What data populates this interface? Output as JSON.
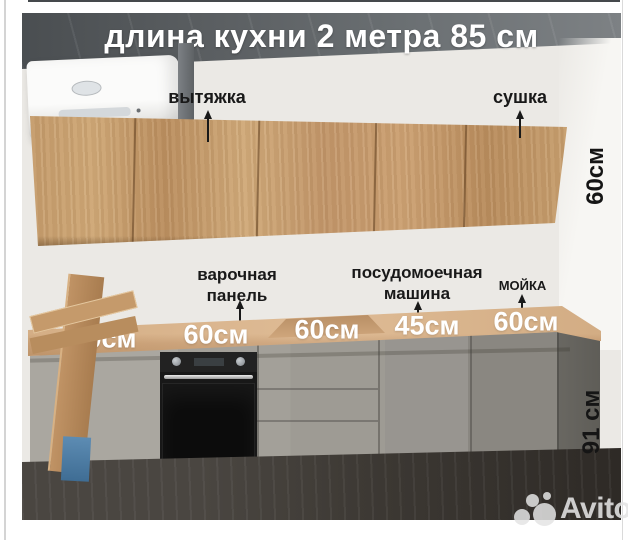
{
  "page": {
    "title": "длина кухни 2 метра 85 см",
    "watermark_text": "Avito"
  },
  "labels": {
    "hood": "вытяжка",
    "dryer": "сушка",
    "hob_line1": "варочная",
    "hob_line2": "панель",
    "dishwasher_line1": "посудомоечная",
    "dishwasher_line2": "машина",
    "sink": "МОЙКА",
    "upper_cabinet_height": "60см",
    "base_cabinet_height": "91 см"
  },
  "counter_widths": [
    "60см",
    "60см",
    "60см",
    "45см",
    "60см"
  ],
  "colors": {
    "wood_cabinet": "#c59c6c",
    "countertop": "#d7b087",
    "base_cabinet_gray": "#9e9b94",
    "ceiling_gray": "#5c6063",
    "floor_dark": "#3c3833",
    "annotation_text": "#191919",
    "dimension_text": "#ffffff"
  }
}
